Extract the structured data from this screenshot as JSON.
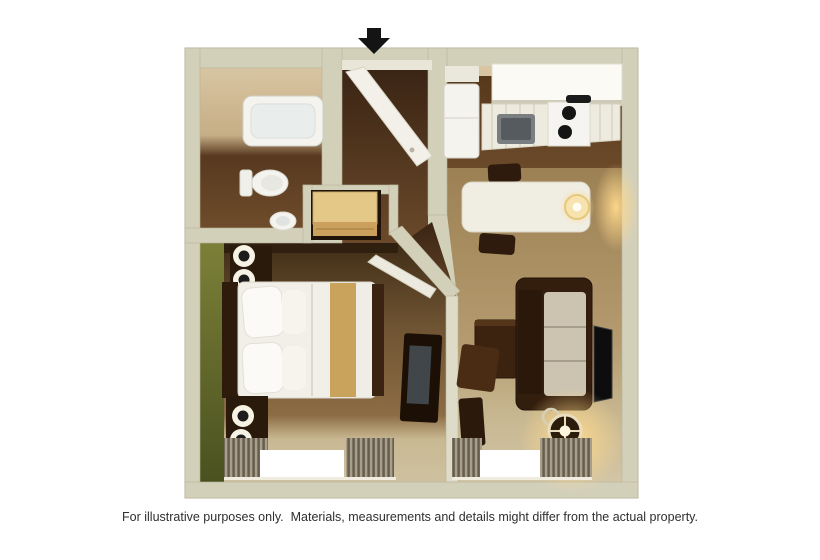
{
  "caption": {
    "text": "For illustrative purposes only.  Materials, measurements and details might differ from the actual property."
  },
  "floorplan": {
    "kind": "3d-rendered-studio-floor-plan",
    "entrance": {
      "icon": "black-down-arrow",
      "position": "top-center"
    },
    "rooms": [
      {
        "name": "bathroom",
        "position": "top-left",
        "furniture": [
          "bathtub",
          "toilet",
          "sink"
        ]
      },
      {
        "name": "entry-hall",
        "position": "top-center",
        "furniture": [
          "open-entry-door"
        ]
      },
      {
        "name": "kitchen",
        "position": "top-right",
        "furniture": [
          "refrigerator",
          "upper-cabinets",
          "counter",
          "kitchen-sink",
          "stove-with-two-burners"
        ]
      },
      {
        "name": "closet",
        "position": "center",
        "furniture": [
          "wood-dresser"
        ]
      },
      {
        "name": "bedroom",
        "position": "bottom-left",
        "accent_wall": "dark-olive-green",
        "furniture": [
          "double-bed-white-linen-gold-runner",
          "dark-headboard",
          "pillows",
          "two-nightstands",
          "two-pairs-round-wall-lamps",
          "tv-dresser-on-divider",
          "window-with-drapes"
        ]
      },
      {
        "name": "living-dining",
        "position": "bottom-right",
        "furniture": [
          "white-dining-table",
          "table-lamp",
          "two-dark-chairs",
          "sofa-dark-frame-light-cushions",
          "wall-mounted-tv",
          "coffee-table",
          "ottoman",
          "glowing-floor-lamp",
          "window-with-drapes"
        ]
      }
    ]
  },
  "colors": {
    "page-bg": "#ffffff",
    "wall": "#d3d0ba",
    "wall-edge": "#b8b39a",
    "wall-bright": "#dedbc8",
    "inner-wall-tan": "#d8c5a2",
    "wood-dark": "#3a2414",
    "wood-mid": "#6b4a2a",
    "carpet-brown": "#6f5433",
    "carpet-tan": "#b49a6e",
    "carpet-light": "#c8b892",
    "accent-green": "#4a511f",
    "accent-green-light": "#7b8038",
    "fixture-white": "#f4f3ee",
    "cushion": "#ccc4b0",
    "furniture-dark": "#2f1b0d",
    "furniture-brown": "#4a2c14",
    "dresser-gold": "#e4c887",
    "bed-runner-gold": "#c9a35b",
    "glow-warm": "#ffd98c",
    "window-bright": "#ffffff",
    "curtain": "#8d8371",
    "arrow-black": "#141414",
    "caption-text": "#2f2f2f"
  }
}
